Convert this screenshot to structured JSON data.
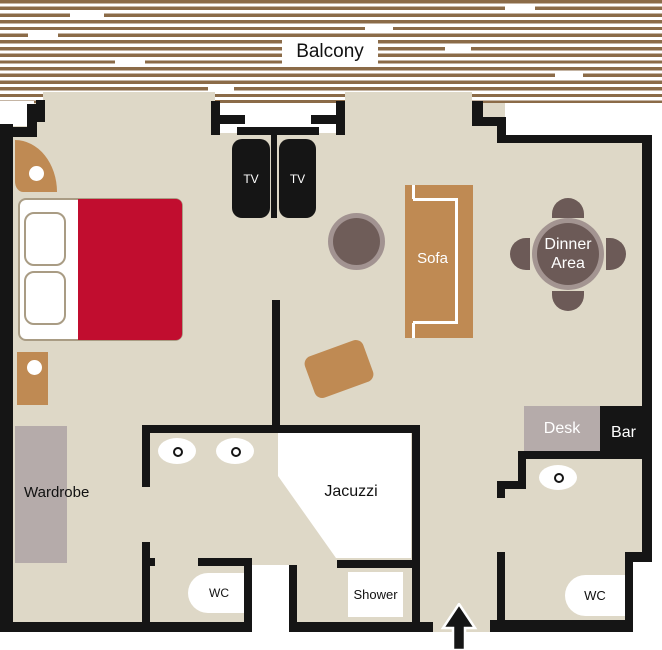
{
  "labels": {
    "balcony": "Balcony",
    "tv_left": "TV",
    "tv_right": "TV",
    "sofa": "Sofa",
    "dinner_area": "Dinner Area",
    "desk": "Desk",
    "bar": "Bar",
    "wardrobe": "Wardrobe",
    "jacuzzi": "Jacuzzi",
    "shower": "Shower",
    "wc_bathroom": "WC",
    "wc_guest": "WC"
  },
  "entrance": {
    "icon": "up-arrow"
  },
  "colors": {
    "floor": "#ded8c7",
    "wall": "#151515",
    "plank": "#8b6b48",
    "red": "#c10d2f",
    "brown": "#bf8a53",
    "gray": "#b5abaa",
    "tdark": "#6f5d59",
    "tring": "#a29391",
    "ddark": "#6c5a57",
    "dring": "#a39491",
    "tan": "#a99c84"
  }
}
